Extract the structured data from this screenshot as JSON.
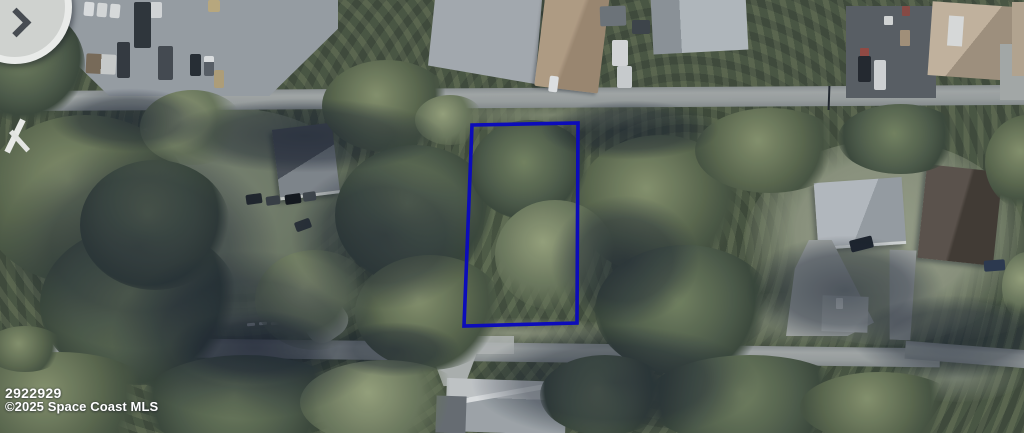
{
  "page": {
    "type": "aerial-map-photo",
    "width": 1024,
    "height": 433
  },
  "watermark": {
    "listing_id": "2922929",
    "copyright_line": "©2025 Space Coast MLS",
    "text_color": "#ffffff"
  },
  "parcel": {
    "points": "472,125 578,123 577,323 464,326",
    "color": "#0b0bc6",
    "stroke_width": "3.6"
  },
  "palette": {
    "canopy_green": "#4d5a43",
    "canopy_shadow": "#18212f",
    "road_gray": "#a2a7a5",
    "lawn_green": "#8d957c",
    "pavement_gray": "#9ba1a7",
    "warehouse_roof_tan": "#b7a083",
    "house_roof_dark_gray": "#4a5057",
    "house_roof_light_gray": "#b9bec2",
    "house_roof_tan": "#c9b89e",
    "house_roof_brown": "#5d5349"
  }
}
